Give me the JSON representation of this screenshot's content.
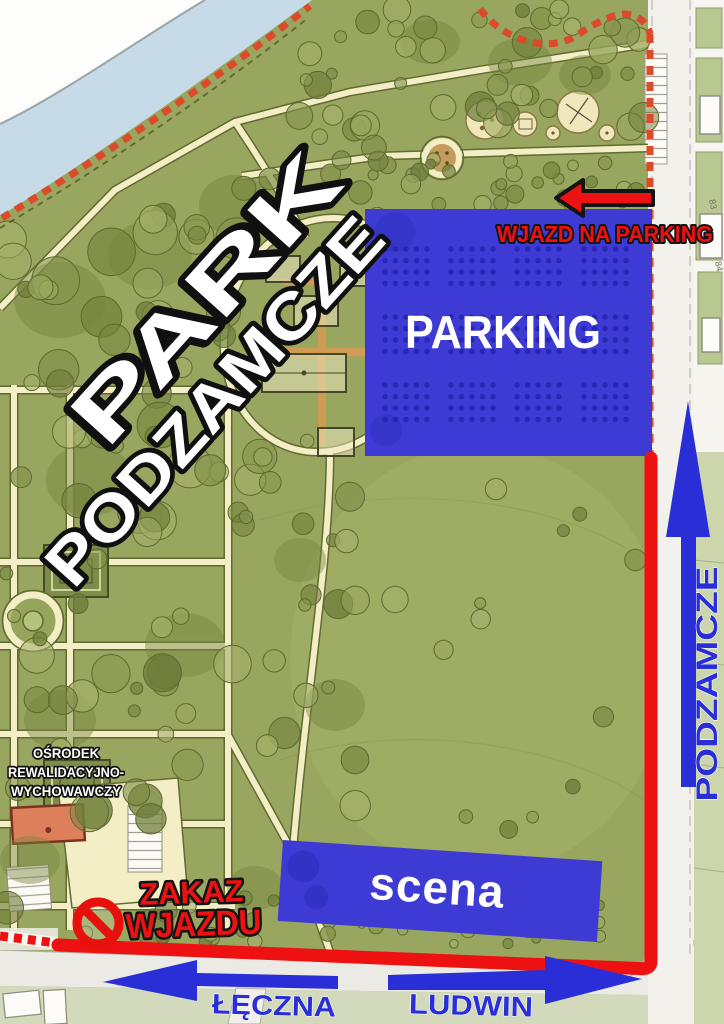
{
  "title": "Park Podzamcze - mapa dojazdu na wydarzenie",
  "colors": {
    "park_green": "#99a65f",
    "river_blue": "#c6dbe7",
    "path_cream": "#f4eec6",
    "accent_blue": "#2a2ed6",
    "parking_blue": "#3d3bd3",
    "accent_red": "#ee1111",
    "boundary_red": "#dc4a2c"
  },
  "park": {
    "line1": "PARK",
    "line2": "PODZAMCZE"
  },
  "parking": {
    "label": "PARKING",
    "entrance_label": "WJAZD NA PARKING",
    "dot_rows": 3,
    "dot_cols": 4
  },
  "stage_area": {
    "label": "scena"
  },
  "streets": {
    "podzamcze": "PODZAMCZE",
    "leczna": "ŁĘCZNA",
    "ludwin": "LUDWIN"
  },
  "no_entry": {
    "line1": "ZAKAZ",
    "line2": "WJAZDU"
  },
  "facility": {
    "line1": "OŚRODEK",
    "line2": "REWALIDACYJNO-",
    "line3": "WYCHOWAWCZY"
  },
  "parcel_labels": [
    "83",
    "84"
  ]
}
